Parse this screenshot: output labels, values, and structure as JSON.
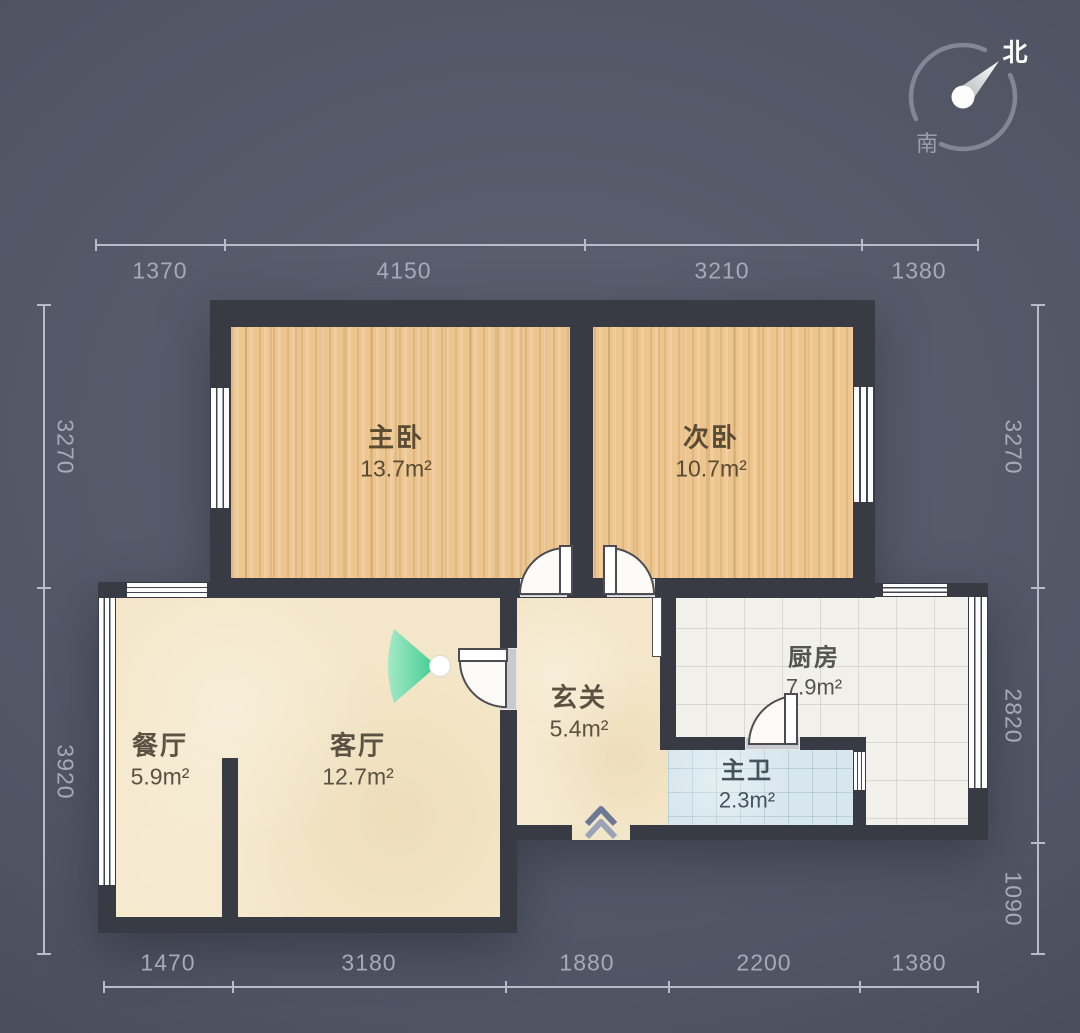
{
  "title": "apartment-floor-plan",
  "compass": {
    "north_label": "北",
    "south_label": "南"
  },
  "rooms": {
    "master_bedroom": {
      "name": "主卧",
      "area": "13.7m²"
    },
    "second_bedroom": {
      "name": "次卧",
      "area": "10.7m²"
    },
    "kitchen": {
      "name": "厨房",
      "area": "7.9m²"
    },
    "entry_hall": {
      "name": "玄关",
      "area": "5.4m²"
    },
    "master_bath": {
      "name": "主卫",
      "area": "2.3m²"
    },
    "dining_room": {
      "name": "餐厅",
      "area": "5.9m²"
    },
    "living_room": {
      "name": "客厅",
      "area": "12.7m²"
    }
  },
  "dimensions_mm": {
    "top": [
      "1370",
      "4150",
      "3210",
      "1380"
    ],
    "bottom": [
      "1470",
      "3180",
      "1880",
      "2200",
      "1380"
    ],
    "left": [
      "3270",
      "3920"
    ],
    "right": [
      "3270",
      "2820",
      "1090"
    ]
  },
  "colors": {
    "background": "#515666",
    "wall": "#383b43",
    "wood_floor": "#edc58e",
    "cream_floor": "#f4e7c9",
    "kitchen_floor": "#f1f0ea",
    "bath_floor": "#d7e7ed",
    "fan_green": "#2ec98b",
    "dimension_text": "#a4abb8"
  }
}
